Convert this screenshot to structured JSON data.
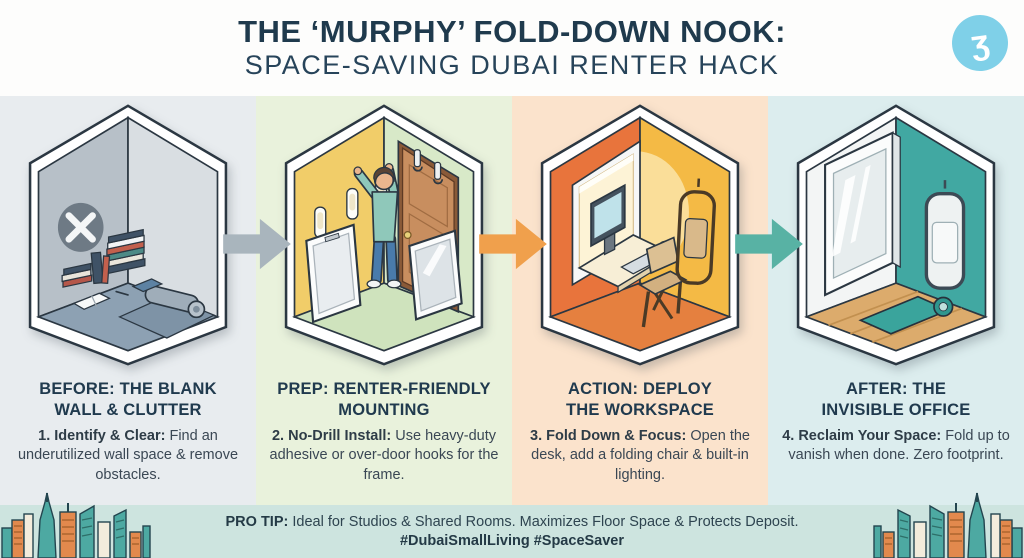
{
  "header": {
    "title_line1": "THE ‘MURPHY’ FOLD-DOWN NOOK:",
    "title_line2": "SPACE-SAVING DUBAI RENTER HACK",
    "logo_glyph": "ʒ"
  },
  "panels": [
    {
      "heading": "BEFORE: THE BLANK\nWALL & CLUTTER",
      "body_lead": "1. Identify & Clear:",
      "body_rest": " Find an underutilized wall space & remove obstacles.",
      "illustration": "cluttered-gray-room-with-x-mark",
      "bg": "#e8ecef"
    },
    {
      "heading": "PREP: RENTER-FRIENDLY\nMOUNTING",
      "body_lead": "2. No-Drill Install:",
      "body_rest": " Use heavy-duty adhesive or over-door hooks for the frame.",
      "illustration": "person-mounting-adhesive-strips-and-door-hooks",
      "bg": "#e9f2dc"
    },
    {
      "heading": "ACTION: DEPLOY\nTHE WORKSPACE",
      "body_lead": "3. Fold Down & Focus:",
      "body_rest": " Open the desk, add a folding chair & built-in lighting.",
      "illustration": "open-fold-down-desk-with-computer-and-folding-chair",
      "bg": "#fbe3cc"
    },
    {
      "heading": "AFTER: THE\nINVISIBLE OFFICE",
      "body_lead": "4. Reclaim Your Space:",
      "body_rest": " Fold up to vanish when done. Zero footprint.",
      "illustration": "folded-panel-room-with-wood-floor-and-mat",
      "bg": "#dcedee"
    }
  ],
  "arrows": [
    {
      "color": "#a9b5bd"
    },
    {
      "color": "#f0a04c"
    },
    {
      "color": "#58b2a4"
    }
  ],
  "footer": {
    "tip_lead": "PRO TIP:",
    "tip_rest": " Ideal for Studios & Shared Rooms. Maximizes Floor Space & Protects Deposit.",
    "hashtags": "#DubaiSmallLiving #SpaceSaver",
    "bg": "#cde4df"
  },
  "colors": {
    "title": "#1f3a4d",
    "heading": "#203a4e",
    "body_text": "#3a4754",
    "logo_bg": "#7fd0e8",
    "room1_walls": [
      "#b7c0c8",
      "#d9dee2",
      "#8da1b3"
    ],
    "room2_walls": [
      "#f1cd69",
      "#d8e9c8",
      "#cfe3bd"
    ],
    "room3_walls": [
      "#e8743c",
      "#f4ba45",
      "#e5803f"
    ],
    "room4_walls": [
      "#f3f5f5",
      "#41a8a2",
      "#dcab6c"
    ],
    "skyline_teal": "#4da9a2",
    "skyline_orange": "#e2894d"
  }
}
